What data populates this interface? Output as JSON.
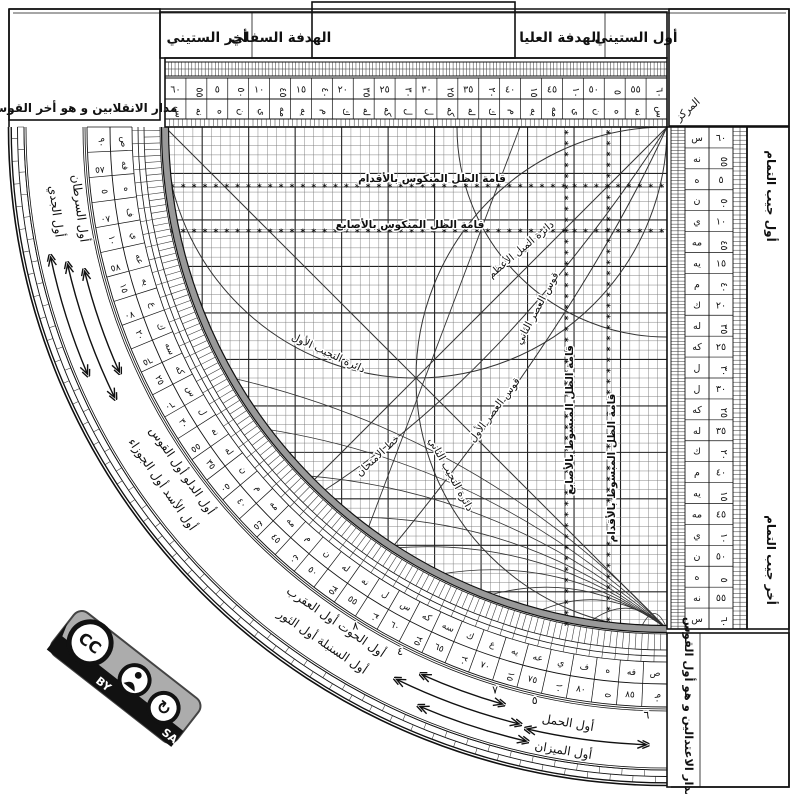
{
  "title": "الربع المجيب",
  "top_band": {
    "first_sixty": "أول الستيني",
    "upper_sight": "الهدفة العليا",
    "lower_sight": "الهدفة السفلي",
    "last_sixty": "أخر الستيني"
  },
  "corners": {
    "center": "المركز",
    "solstice_box": "مدار الانقلابين و هو أخر القوس",
    "equinox_box": "مدار الاعتدالين و هو أول القوس",
    "cosine_first": "أول جيب التمام",
    "cosine_last": "أخر جيب التمام"
  },
  "grid_labels": [
    "قامة الظل المنكوس بالأقدام",
    "قامة الظل المنكوس بالأصابع",
    "قامة الظل المبسوط بالأصابع",
    "قامة الظل المبسوط بالأقدام",
    "دائرة الميل الأعظم",
    "قوس العصر الثاني",
    "قوس العصر الأول",
    "خط الامتحان",
    "دائرة التجيب الأول",
    "دائرة التجيب الثاني"
  ],
  "zodiac_labels": [
    {
      "text": "أول الجدي",
      "r": 620,
      "a": 88,
      "b": 77
    },
    {
      "text": "أول السرطان",
      "r": 596,
      "a": 88,
      "b": 77
    },
    {
      "text": "أول الأسد أول الجوزاء",
      "r": 620,
      "a": 64,
      "b": 46
    },
    {
      "text": "أول الدلو أول القوس",
      "r": 596,
      "a": 64,
      "b": 46
    },
    {
      "text": "أول السنبلة أول الثور",
      "r": 620,
      "a": 42,
      "b": 26
    },
    {
      "text": "أول الحوت أول العقرب",
      "r": 596,
      "a": 42,
      "b": 26
    },
    {
      "text": "أول الحمل",
      "r": 604,
      "a": 16,
      "b": 3
    },
    {
      "text": "أول الميزان",
      "r": 632,
      "a": 16,
      "b": 3
    }
  ],
  "scales": {
    "sixty": [
      60,
      55,
      5,
      50,
      10,
      45,
      15,
      40,
      20,
      35,
      25,
      30,
      30,
      25,
      35,
      20,
      40,
      15,
      45,
      10,
      50,
      5,
      55,
      60
    ],
    "arc_degrees": [
      90,
      85,
      5,
      80,
      10,
      75,
      15,
      70,
      20,
      65,
      25,
      60,
      30,
      55,
      35,
      50,
      40,
      45,
      45,
      40,
      50,
      35,
      55,
      30,
      60,
      25,
      65,
      20,
      70,
      15,
      75,
      10,
      80,
      5,
      85,
      90
    ],
    "abjad": {
      "5": "ه",
      "10": "ي",
      "15": "يه",
      "20": "ك",
      "25": "كه",
      "30": "ل",
      "35": "له",
      "40": "م",
      "45": "مه",
      "50": "ن",
      "55": "نه",
      "60": "س",
      "65": "سه",
      "70": "ع",
      "75": "عه",
      "80": "ف",
      "85": "فه",
      "90": "ص"
    }
  },
  "hour_numbers": [
    {
      "n": 6,
      "deg": 2
    },
    {
      "n": 5,
      "deg": 13
    },
    {
      "n": 7,
      "deg": 17
    },
    {
      "n": 4,
      "deg": 27
    },
    {
      "n": 8,
      "deg": 32
    }
  ],
  "arrow_arcs": [
    {
      "r": 600,
      "a": 66,
      "b": 76
    },
    {
      "r": 600,
      "a": 16,
      "b": 24
    },
    {
      "r": 615,
      "a": 64,
      "b": 77
    },
    {
      "r": 615,
      "a": 14,
      "b": 26
    },
    {
      "r": 630,
      "a": 67,
      "b": 78
    },
    {
      "r": 630,
      "a": 13,
      "b": 23
    },
    {
      "r": 618,
      "a": 2,
      "b": 13
    }
  ],
  "license": {
    "cc": "CC",
    "by": "BY",
    "sa": "SA"
  },
  "colors": {
    "ink": "#111111",
    "arc_gray": "#999999",
    "badge_gray": "#acacac"
  }
}
